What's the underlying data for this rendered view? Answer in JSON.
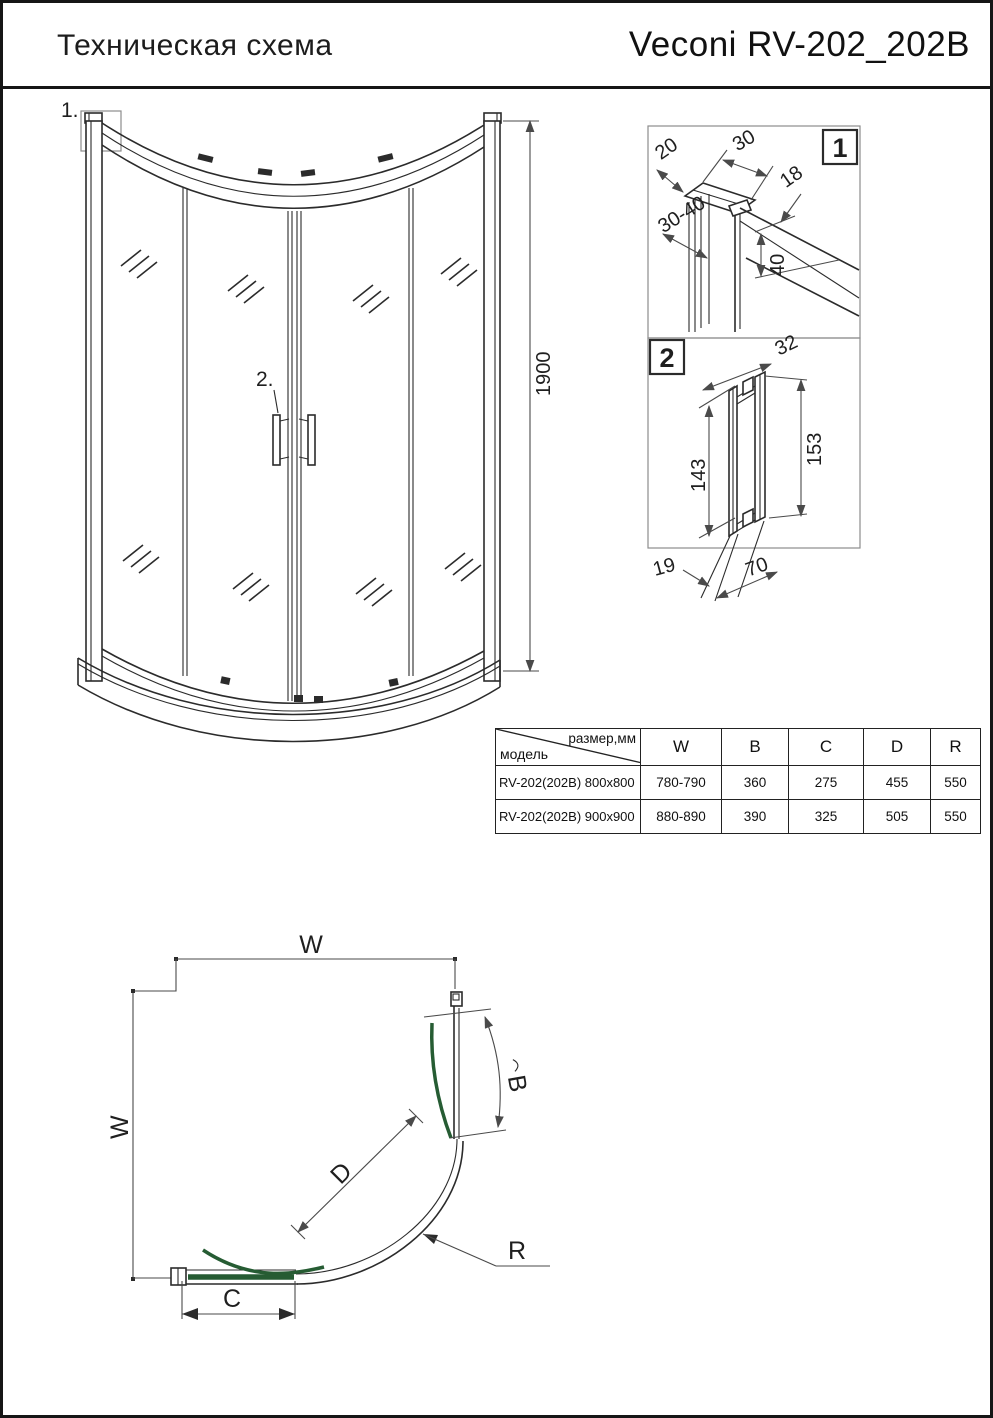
{
  "colors": {
    "ink": "#2b2b2b",
    "dim": "#4a4a4a",
    "door_green": "#265c33",
    "frame_gray": "#8d8d8d"
  },
  "header": {
    "title_left": "Техническая схема",
    "title_right": "Veconi RV-202_202B"
  },
  "main_view": {
    "callout_1": "1.",
    "callout_2": "2.",
    "height": "1900"
  },
  "details": {
    "detail_1": {
      "badge": "1",
      "dims": [
        "20",
        "30",
        "18",
        "30-40",
        "40"
      ]
    },
    "detail_2": {
      "badge": "2",
      "dims": [
        "32",
        "143",
        "153",
        "19",
        "70"
      ]
    }
  },
  "table": {
    "corner_top": "размер,мм",
    "corner_bottom": "модель",
    "columns": [
      "W",
      "B",
      "C",
      "D",
      "R"
    ],
    "rows": [
      {
        "model": "RV-202(202B) 800x800",
        "W": "780-790",
        "B": "360",
        "C": "275",
        "D": "455",
        "R": "550"
      },
      {
        "model": "RV-202(202B) 900x900",
        "W": "880-890",
        "B": "390",
        "C": "325",
        "D": "505",
        "R": "550"
      }
    ]
  },
  "plan_view": {
    "w_top": "W",
    "w_left": "W",
    "b": "B",
    "c": "C",
    "d": "D",
    "r": "R"
  }
}
